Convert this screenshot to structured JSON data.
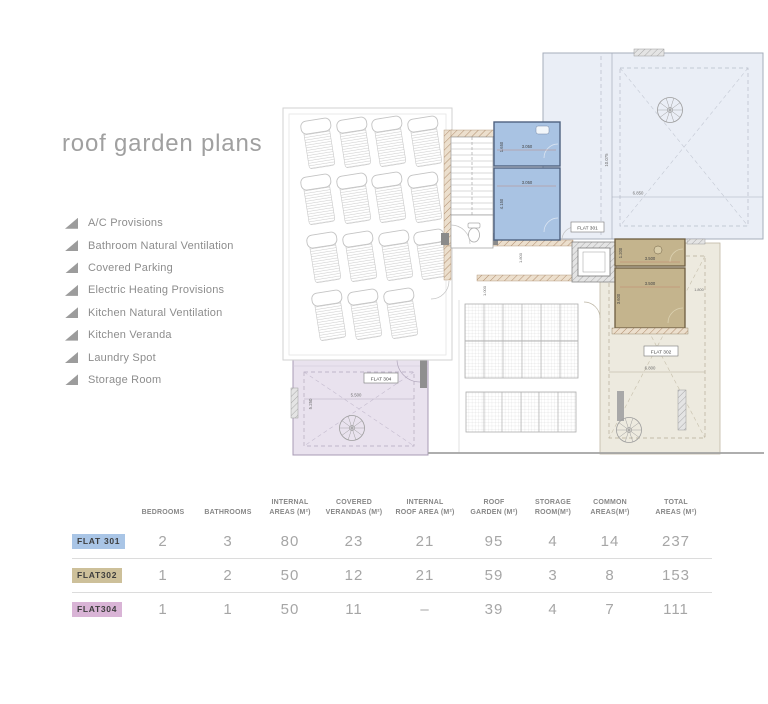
{
  "page": {
    "title": "roof garden plans"
  },
  "features": [
    "A/C Provisions",
    "Bathroom Natural Ventilation",
    "Covered Parking",
    "Electric Heating Provisions",
    "Kitchen Natural Ventilation",
    "Kitchen Veranda",
    "Laundry Spot",
    "Storage Room"
  ],
  "icons": {
    "bullet": "filled-right-triangle",
    "fan": "spiral-stair-top-view",
    "car": "parked-car-plan-symbol"
  },
  "plan": {
    "flats": {
      "f301": "FLAT 301",
      "f302": "FLAT 302",
      "f304": "FLAT 304"
    },
    "dims": {
      "b1h": "1.650",
      "b1w": "3.050",
      "b2w": "3.050",
      "b2h": "4.150",
      "g301h": "10.075",
      "g301w": "6.850",
      "c1": "1.800",
      "c2": "1.000",
      "t1h": "1.200",
      "t1w": "3.500",
      "t2w": "3.500",
      "t2h": "3.600",
      "g302w": "6.800",
      "g302e": "1.800",
      "g304w": "5.500",
      "g304h": "5.250"
    }
  },
  "table": {
    "columns": [
      {
        "l1": "BEDROOMS",
        "l2": ""
      },
      {
        "l1": "BATHROOMS",
        "l2": ""
      },
      {
        "l1": "INTERNAL",
        "l2": "AREAS (M²)"
      },
      {
        "l1": "COVERED",
        "l2": "VERANDAS (M²)"
      },
      {
        "l1": "INTERNAL",
        "l2": "ROOF AREA (M²)"
      },
      {
        "l1": "ROOF",
        "l2": "GARDEN (M²)"
      },
      {
        "l1": "STORAGE",
        "l2": "ROOM(M²)"
      },
      {
        "l1": "COMMON",
        "l2": "AREAS(M²)"
      },
      {
        "l1": "TOTAL",
        "l2": "AREAS (M²)"
      }
    ],
    "rows": [
      {
        "label": "FLAT 301",
        "values": [
          "2",
          "3",
          "80",
          "23",
          "21",
          "95",
          "4",
          "14",
          "237"
        ]
      },
      {
        "label": "FLAT302",
        "values": [
          "1",
          "2",
          "50",
          "12",
          "21",
          "59",
          "3",
          "8",
          "153"
        ]
      },
      {
        "label": "FLAT304",
        "values": [
          "1",
          "1",
          "50",
          "11",
          "–",
          "39",
          "4",
          "7",
          "111"
        ]
      }
    ]
  },
  "colors": {
    "flat301_chip": "#a9c5e6",
    "flat302_chip": "#cdc09a",
    "flat304_chip": "#d9b4d6",
    "blue_rooms": "#a9c3e3",
    "tan_rooms": "#c4b48d",
    "garden301": "#eaeef6",
    "garden302": "#edeadf",
    "garden304": "#e9e2ee"
  }
}
